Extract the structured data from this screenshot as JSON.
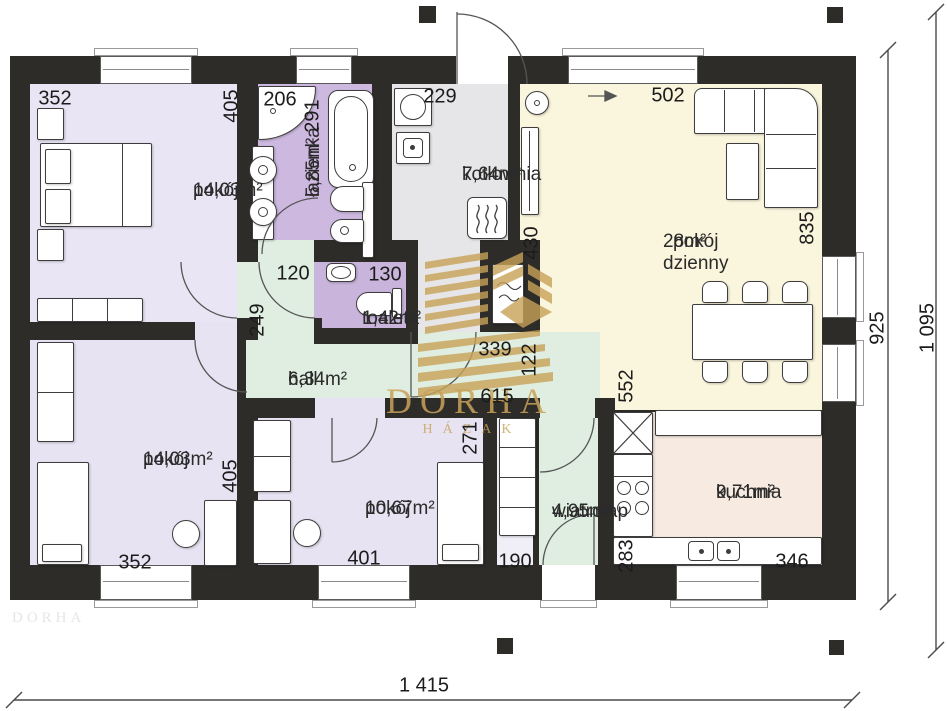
{
  "watermark": {
    "line1": "DORHA",
    "line2": "HÁZAK",
    "color": "#c8a258"
  },
  "rooms": [
    {
      "id": "pokoj-gorny-lewy",
      "name": "pokój",
      "area": "14,03m²",
      "x": 193,
      "y": 180,
      "vertical": false
    },
    {
      "id": "lazienka",
      "name": "łazienka",
      "area": "5,85m²",
      "x": 303,
      "y": 197,
      "vertical": true
    },
    {
      "id": "kotlownia",
      "name": "kotłownia",
      "area": "7,64m²",
      "x": 462,
      "y": 164,
      "vertical": false
    },
    {
      "id": "toaleta",
      "name": "toaleta",
      "area": "1,42m²",
      "x": 362,
      "y": 308,
      "vertical": false
    },
    {
      "id": "hall",
      "name": "hall",
      "area": "6,34m²",
      "x": 288,
      "y": 369,
      "vertical": false
    },
    {
      "id": "pokoj-dzienny",
      "name": "pokój\ndzienny",
      "area": "28m²",
      "x": 663,
      "y": 231,
      "vertical": false
    },
    {
      "id": "pokoj-dolny-lewy",
      "name": "pokój",
      "area": "14,03m²",
      "x": 143,
      "y": 449,
      "vertical": false
    },
    {
      "id": "pokoj-dolny-srodkowy",
      "name": "pokój",
      "area": "10,67m²",
      "x": 365,
      "y": 498,
      "vertical": false
    },
    {
      "id": "wiatrolap",
      "name": "wiatrołap",
      "area": "4,95m²",
      "x": 552,
      "y": 501,
      "vertical": false
    },
    {
      "id": "kuchnia",
      "name": "kuchnia",
      "area": "9,71m²",
      "x": 716,
      "y": 482,
      "vertical": false
    }
  ],
  "dimensions": [
    {
      "t": "352",
      "x": 55,
      "y": 99,
      "v": false
    },
    {
      "t": "405",
      "x": 232,
      "y": 106,
      "v": true
    },
    {
      "t": "206",
      "x": 280,
      "y": 100,
      "v": false
    },
    {
      "t": "291",
      "x": 313,
      "y": 116,
      "v": true
    },
    {
      "t": "229",
      "x": 440,
      "y": 97,
      "v": false
    },
    {
      "t": "502",
      "x": 668,
      "y": 96,
      "v": false
    },
    {
      "t": "430",
      "x": 532,
      "y": 243,
      "v": true
    },
    {
      "t": "835",
      "x": 808,
      "y": 228,
      "v": true
    },
    {
      "t": "120",
      "x": 293,
      "y": 274,
      "v": false
    },
    {
      "t": "130",
      "x": 385,
      "y": 275,
      "v": false
    },
    {
      "t": "249",
      "x": 258,
      "y": 320,
      "v": true
    },
    {
      "t": "339",
      "x": 495,
      "y": 350,
      "v": false
    },
    {
      "t": "122",
      "x": 530,
      "y": 360,
      "v": true
    },
    {
      "t": "615",
      "x": 497,
      "y": 397,
      "v": false
    },
    {
      "t": "552",
      "x": 627,
      "y": 386,
      "v": true
    },
    {
      "t": "271",
      "x": 471,
      "y": 438,
      "v": true
    },
    {
      "t": "401",
      "x": 364,
      "y": 559,
      "v": false
    },
    {
      "t": "352",
      "x": 135,
      "y": 563,
      "v": false
    },
    {
      "t": "405",
      "x": 231,
      "y": 476,
      "v": true
    },
    {
      "t": "190",
      "x": 515,
      "y": 562,
      "v": false
    },
    {
      "t": "283",
      "x": 627,
      "y": 556,
      "v": true
    },
    {
      "t": "346",
      "x": 792,
      "y": 562,
      "v": false
    },
    {
      "t": "1 415",
      "x": 424,
      "y": 686,
      "v": false,
      "overall": true
    },
    {
      "t": "925",
      "x": 878,
      "y": 328,
      "v": true,
      "overall": true
    },
    {
      "t": "1 095",
      "x": 928,
      "y": 328,
      "v": true,
      "overall": true
    }
  ],
  "colors": {
    "wall": "#2e2c29",
    "room_lavender": "#e9e5f4",
    "room_purple": "#cdb9e0",
    "room_gray": "#e6e6e8",
    "room_cream": "#faf5dd",
    "room_green": "#dfeee1",
    "room_pink": "#f7eae1",
    "watermark_gold": "#c8a258"
  }
}
